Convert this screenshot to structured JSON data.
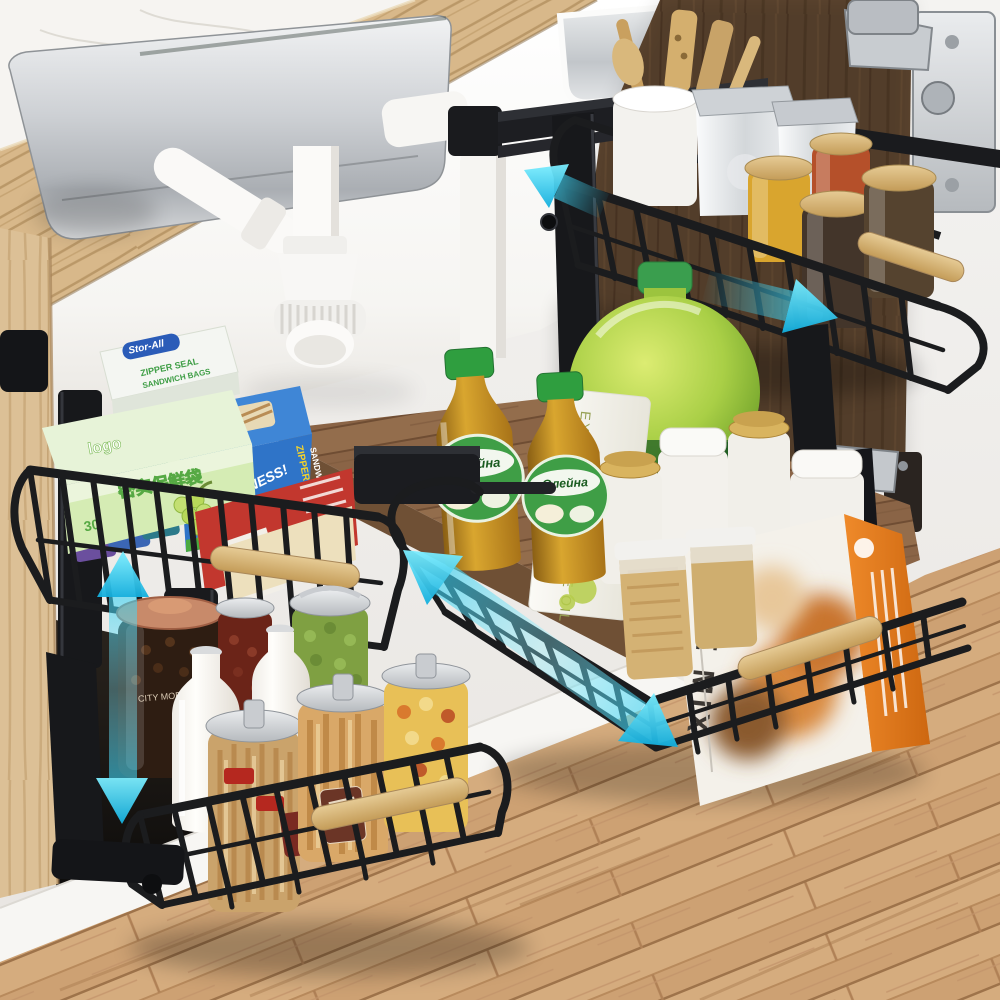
{
  "labels": {
    "back_wrap_box": {
      "brand": "Stor-All",
      "line1": "ZIPPER SEAL",
      "line2": "SANDWICH BAGS"
    },
    "green_wrap_box": {
      "brand": "logo",
      "title": "密实保鲜袋",
      "count": "30"
    },
    "blue_wrap_box": {
      "brand": "Stor-All",
      "slogan_small": "Seals In The",
      "slogan": "FRESHNESS!",
      "side_line1": "ZIPPER SEAL",
      "side_line2": "SANDWICH BAGS"
    },
    "foil_box": {
      "brand": "SILVER"
    },
    "oil_bottle": {
      "brand": "Олейна"
    },
    "olive_oil_carton": {
      "text": "EXTRA VIRGIN OLIVE OIL"
    },
    "pie_mix_box": {
      "title": "PIE MIX"
    },
    "coffee_jar": {
      "label": "CITY MORNING"
    }
  },
  "colors": {
    "accent_cyan": "#2fc8ec",
    "basket_black": "#17181b",
    "bamboo": "#d9b87c",
    "door_wood": "#5e4630",
    "shelf_wood": "#8a6446",
    "floor_wood": "#cda173",
    "frame_wood": "#dcc096",
    "cap_green": "#2f9e3f",
    "jug_green": "#9cc43e",
    "foil_red": "#c2372e",
    "box_blue": "#2f74c8",
    "orange_panel": "#e07a20",
    "marble_white": "#f5f3f0"
  }
}
